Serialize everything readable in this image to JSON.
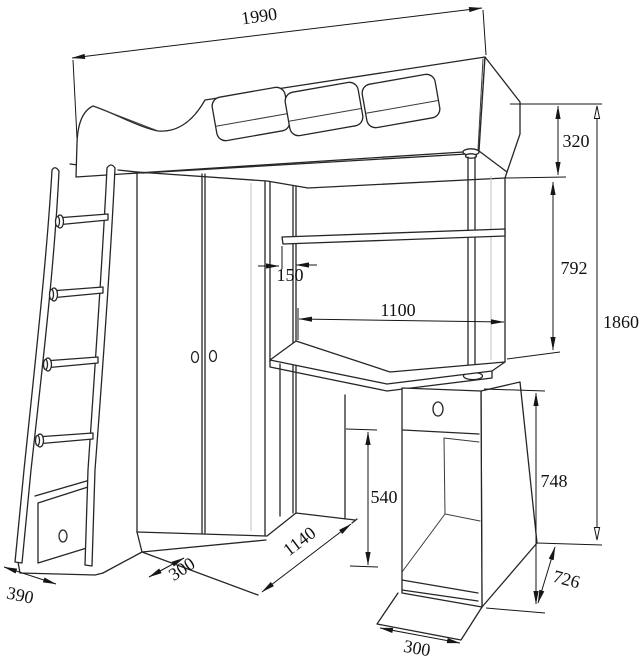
{
  "drawing": {
    "subject": "Loft bed with wardrobe, corner desk, pedestal and ladder — dimensioned technical line drawing",
    "units": "mm",
    "line_color": "#262626",
    "background_color": "#ffffff"
  },
  "dimensions": {
    "overall_width": "1990",
    "rail_height": "320",
    "under_bed_clearance": "792",
    "overall_height": "1860",
    "shelf_inset": "150",
    "desk_length": "1100",
    "cabinet_opening_height": "540",
    "pedestal_height": "748",
    "pedestal_side_depth": "726",
    "floor_front_depth": "1140",
    "wardrobe_floor_depth": "300",
    "ladder_depth": "390",
    "pedestal_width": "300"
  }
}
